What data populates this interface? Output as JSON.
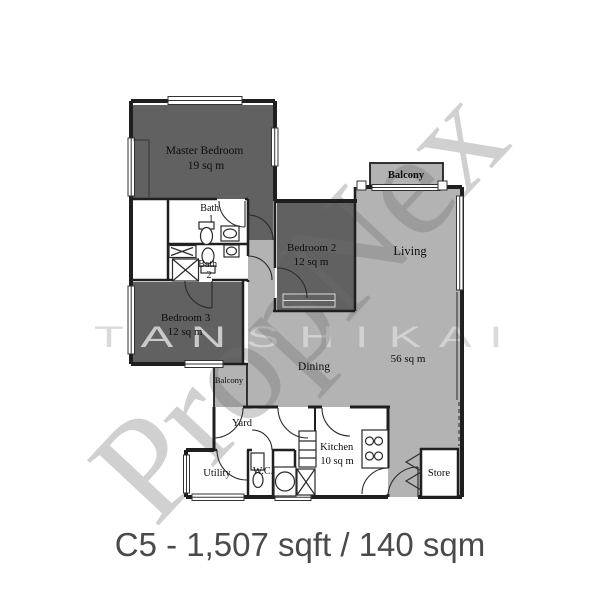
{
  "plan": {
    "rooms": {
      "master_bedroom": {
        "name": "Master Bedroom",
        "area": "19 sq m"
      },
      "bath_1": {
        "name": "Bath",
        "number": "1"
      },
      "bath_2": {
        "name": "Bath",
        "number": "2"
      },
      "bedroom_2": {
        "name": "Bedroom 2",
        "area": "12 sq m"
      },
      "bedroom_3": {
        "name": "Bedroom 3",
        "area": "12 sq m"
      },
      "living": {
        "name": "Living"
      },
      "dining": {
        "name": "Dining"
      },
      "open_area": {
        "area": "56 sq m"
      },
      "balcony_top": {
        "name": "Balcony"
      },
      "balcony_side": {
        "name": "Balcony"
      },
      "yard": {
        "name": "Yard"
      },
      "utility": {
        "name": "Utility"
      },
      "wc": {
        "name": "W.C."
      },
      "kitchen": {
        "name": "Kitchen",
        "area": "10 sq m"
      },
      "store": {
        "name": "Store"
      }
    },
    "watermark": {
      "brand": "PropNex",
      "agent": "T A N   S H I   K A I"
    },
    "caption": "C5 - 1,507 sqft / 140 sqm",
    "colors": {
      "bedroom_fill": "#616161",
      "living_fill": "#b3b3b3",
      "wall": "#1f1f1f",
      "caption_text": "#4a4a4a"
    }
  }
}
